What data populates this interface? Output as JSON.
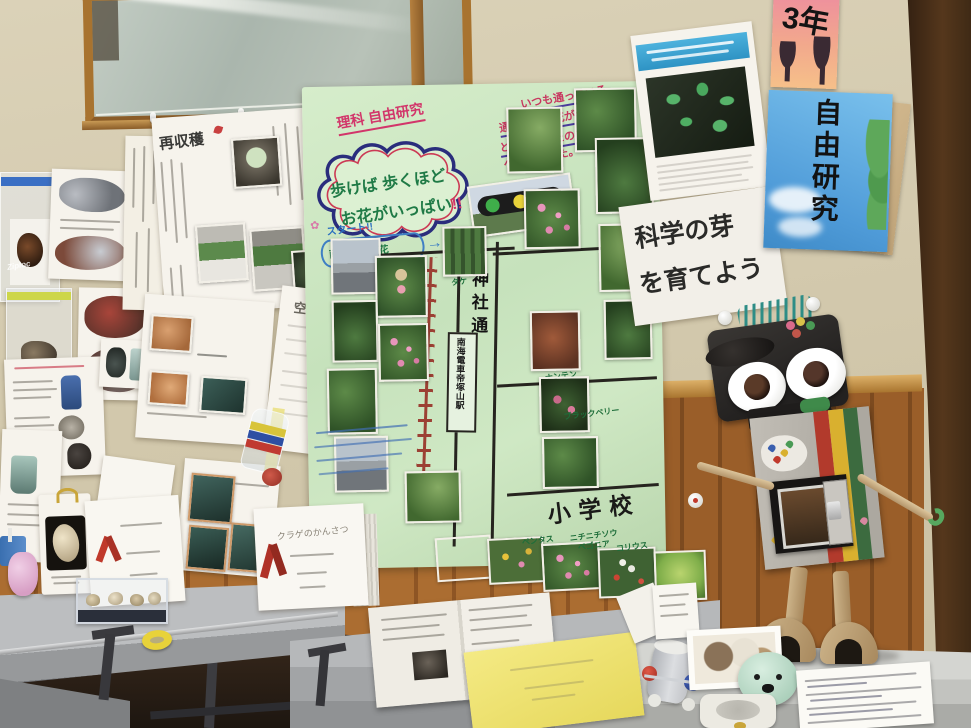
{
  "labels": {
    "ziploc_brand": "Ziploc",
    "reharvest_title": "再収穫",
    "air_cannon_title": "空気ほう",
    "jellyfish_title": "クラゲのかんさつ"
  },
  "green_poster": {
    "header": "理科 自由研究",
    "cloud_line1": "歩けば 歩くほど",
    "cloud_line2": "お花がいっぱい",
    "cloud_bangs": "!!",
    "intro_line1": "いつも通っている",
    "intro_line2": "通学路のお花がキレイだな",
    "intro_line3": "と思っていたので草花を調",
    "intro_line4": "べてみました。",
    "start_label": "スタート!!",
    "flower_doodle": "✿",
    "area_label": "南港通の草花",
    "arrow_blue": "→",
    "shrine_street": "神社通",
    "station_label": "南海電車帝塚山駅",
    "school_label": "小学校",
    "plant_labels": {
      "bamboo": "タケ",
      "nanten": "ナンテン",
      "blackberry": "ブラックベリー",
      "pentas": "ペンタス",
      "nichinichisou": "ニチニチソウ",
      "begonia": "ベゴニア",
      "coleus": "コリウス"
    }
  },
  "right_posters": {
    "science_line1": "科学の芽",
    "science_line2": "を育てよう",
    "grade": "3年",
    "free_research": "自由研究"
  }
}
